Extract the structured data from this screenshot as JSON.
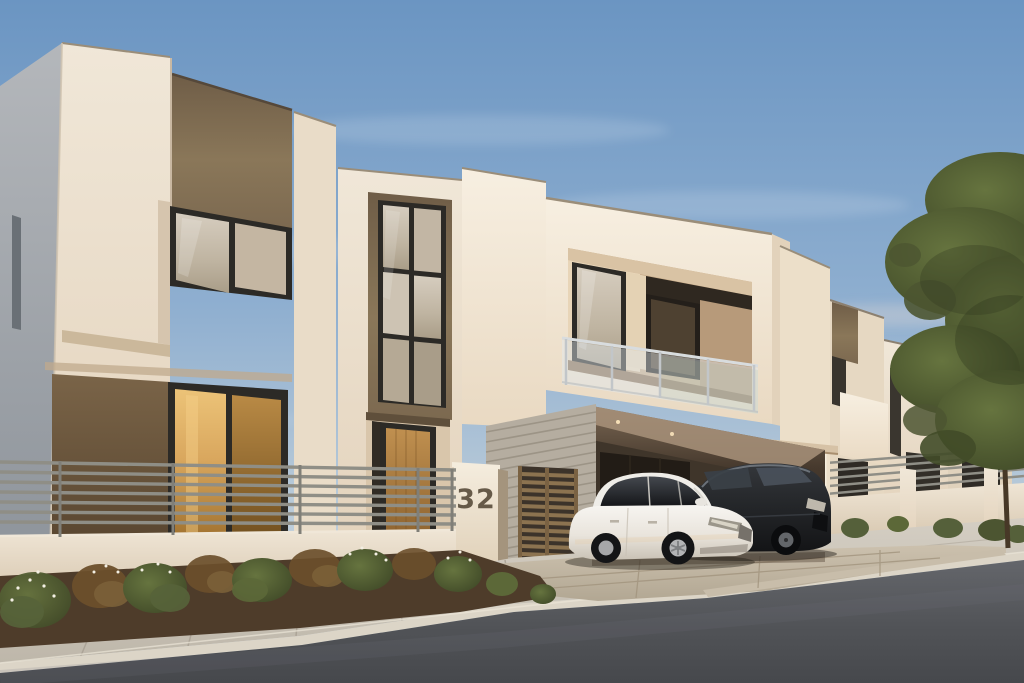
{
  "scene": {
    "setting": "modern two-storey townhouse row photographed from the street at dusk",
    "house_number": "32",
    "house_units_visible": 4,
    "cars": [
      {
        "color": "white",
        "type": "sedan",
        "position": "parked in carport, nose out"
      },
      {
        "color": "black",
        "type": "sedan",
        "position": "parked beside white sedan"
      }
    ],
    "features": [
      "cream stucco cubic facades",
      "brown accent wall panels",
      "dark-framed windows reflecting dusk sky",
      "recessed balcony with glass railing",
      "carport with recessed ceiling lights",
      "bronze slatted pedestrian gate",
      "house number pillar",
      "horizontal slat metal fence on low wall",
      "planting bed with shrubs and small white flowers",
      "concrete sidewalk, curb and asphalt street",
      "leafy tree at right edge",
      "clear blue sky with thin clouds"
    ]
  },
  "palette": {
    "page_bg": "#1e2126",
    "sky_top": "#6b95c2",
    "sky_horizon": "#d2dbe0",
    "cloud_white": "#ffffff",
    "facade_cream": "#eadfcd",
    "facade_bright": "#f4ebdc",
    "facade_shadow": "#d8c7b0",
    "side_wall_cool": "#a9aeb4",
    "accent_brown": "#7e6b50",
    "accent_brown_dark": "#5e4b34",
    "window_frame": "#2c2a26",
    "glass_reflection": "#cdc3b3",
    "glass_gold": "#d9a75e",
    "wood_door": "#b9873f",
    "railing_metal": "#c2c6c9",
    "railing_glass": "#dfe9f0",
    "fence_gray": "#8f8e86",
    "fence_post": "#807f78",
    "fence_wall": "#e8ddca",
    "gate_bronze": "#8c7350",
    "pillar_cream": "#f0e7d8",
    "house_number_color": "#665a49",
    "stripe_wall": "#b5ada0",
    "stripe_wall_line": "#968e80",
    "carport_shadow": "#352c23",
    "garage_door": "#221c16",
    "car_white": "#f2f0ec",
    "car_black": "#1b1d20",
    "wheel_rim": "#b3b4b6",
    "driveway": "#c6bba8",
    "sidewalk": "#cac3b7",
    "curb": "#dcd5c7",
    "asphalt": "#54565b",
    "mulch": "#4e3c2a",
    "shrub_green": "#66713f",
    "shrub_dry": "#7b6138",
    "flower_white": "#f3efe3",
    "tree_foliage": "#4c5531",
    "tree_trunk": "#473827"
  }
}
